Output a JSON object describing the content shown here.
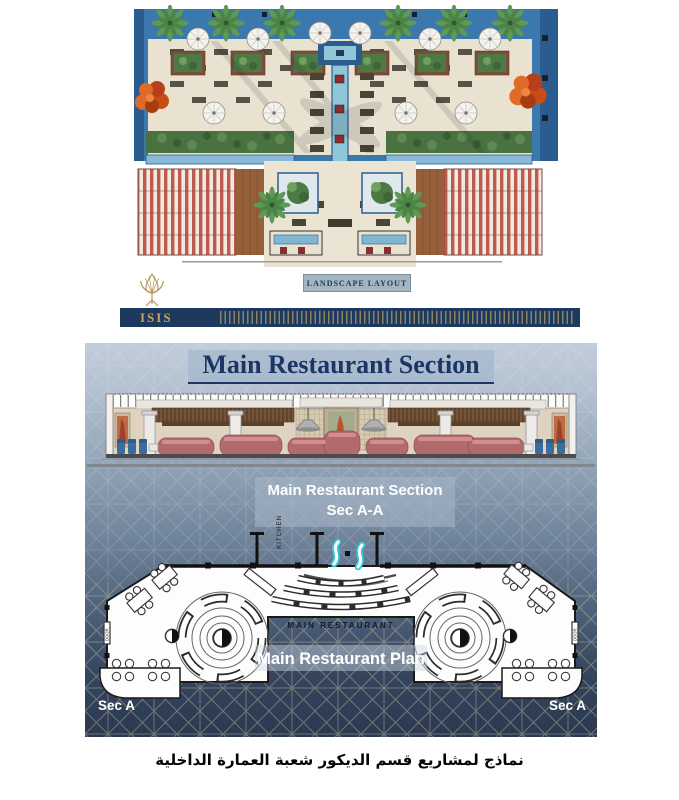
{
  "page": {
    "caption": "نماذج لمشاريع قسم الديكور شعبة العمارة الداخلية"
  },
  "landscape_board": {
    "label": "LANDSCAPE LAYOUT",
    "logo": {
      "text": "ISIS",
      "icon": "lotus-flower"
    },
    "colors": {
      "banner_bg": "#1d3a5e",
      "gold": "#c9a45c",
      "pool_blue": "#3a78ad",
      "paving_beige": "#eae2d0",
      "label_bg": "#a3b6bf",
      "label_text": "#1e3a5a",
      "orange_tree": "#d4571c",
      "palm_green": "#5e9a55",
      "water_channel": "#8fc6d8",
      "pergola_red": "#bf5a4e"
    }
  },
  "restaurant_board": {
    "title": "Main Restaurant Section",
    "section_label": {
      "line1": "Main Restaurant Section",
      "line2": "Sec A-A"
    },
    "kitchen_label": "KITCHEN",
    "plan_small_label": "MAIN RESTAURANT",
    "plan_label": "Main Restaurant Plan",
    "sec_left": "Sec A",
    "sec_right": "Sec A",
    "door_label": "DOOR",
    "colors": {
      "bg_top": "#c2cdd9",
      "bg_bottom": "#2a3950",
      "title_text": "#1c3564",
      "title_highlight": "#a3b5cd",
      "label_box": "#93a5b8",
      "label_text": "#ffffff",
      "booth_pink": "#b26a6c",
      "chair_blue": "#3a6d9e",
      "water_cyan": "#35c8dc",
      "wood_brown": "#74543a"
    }
  }
}
